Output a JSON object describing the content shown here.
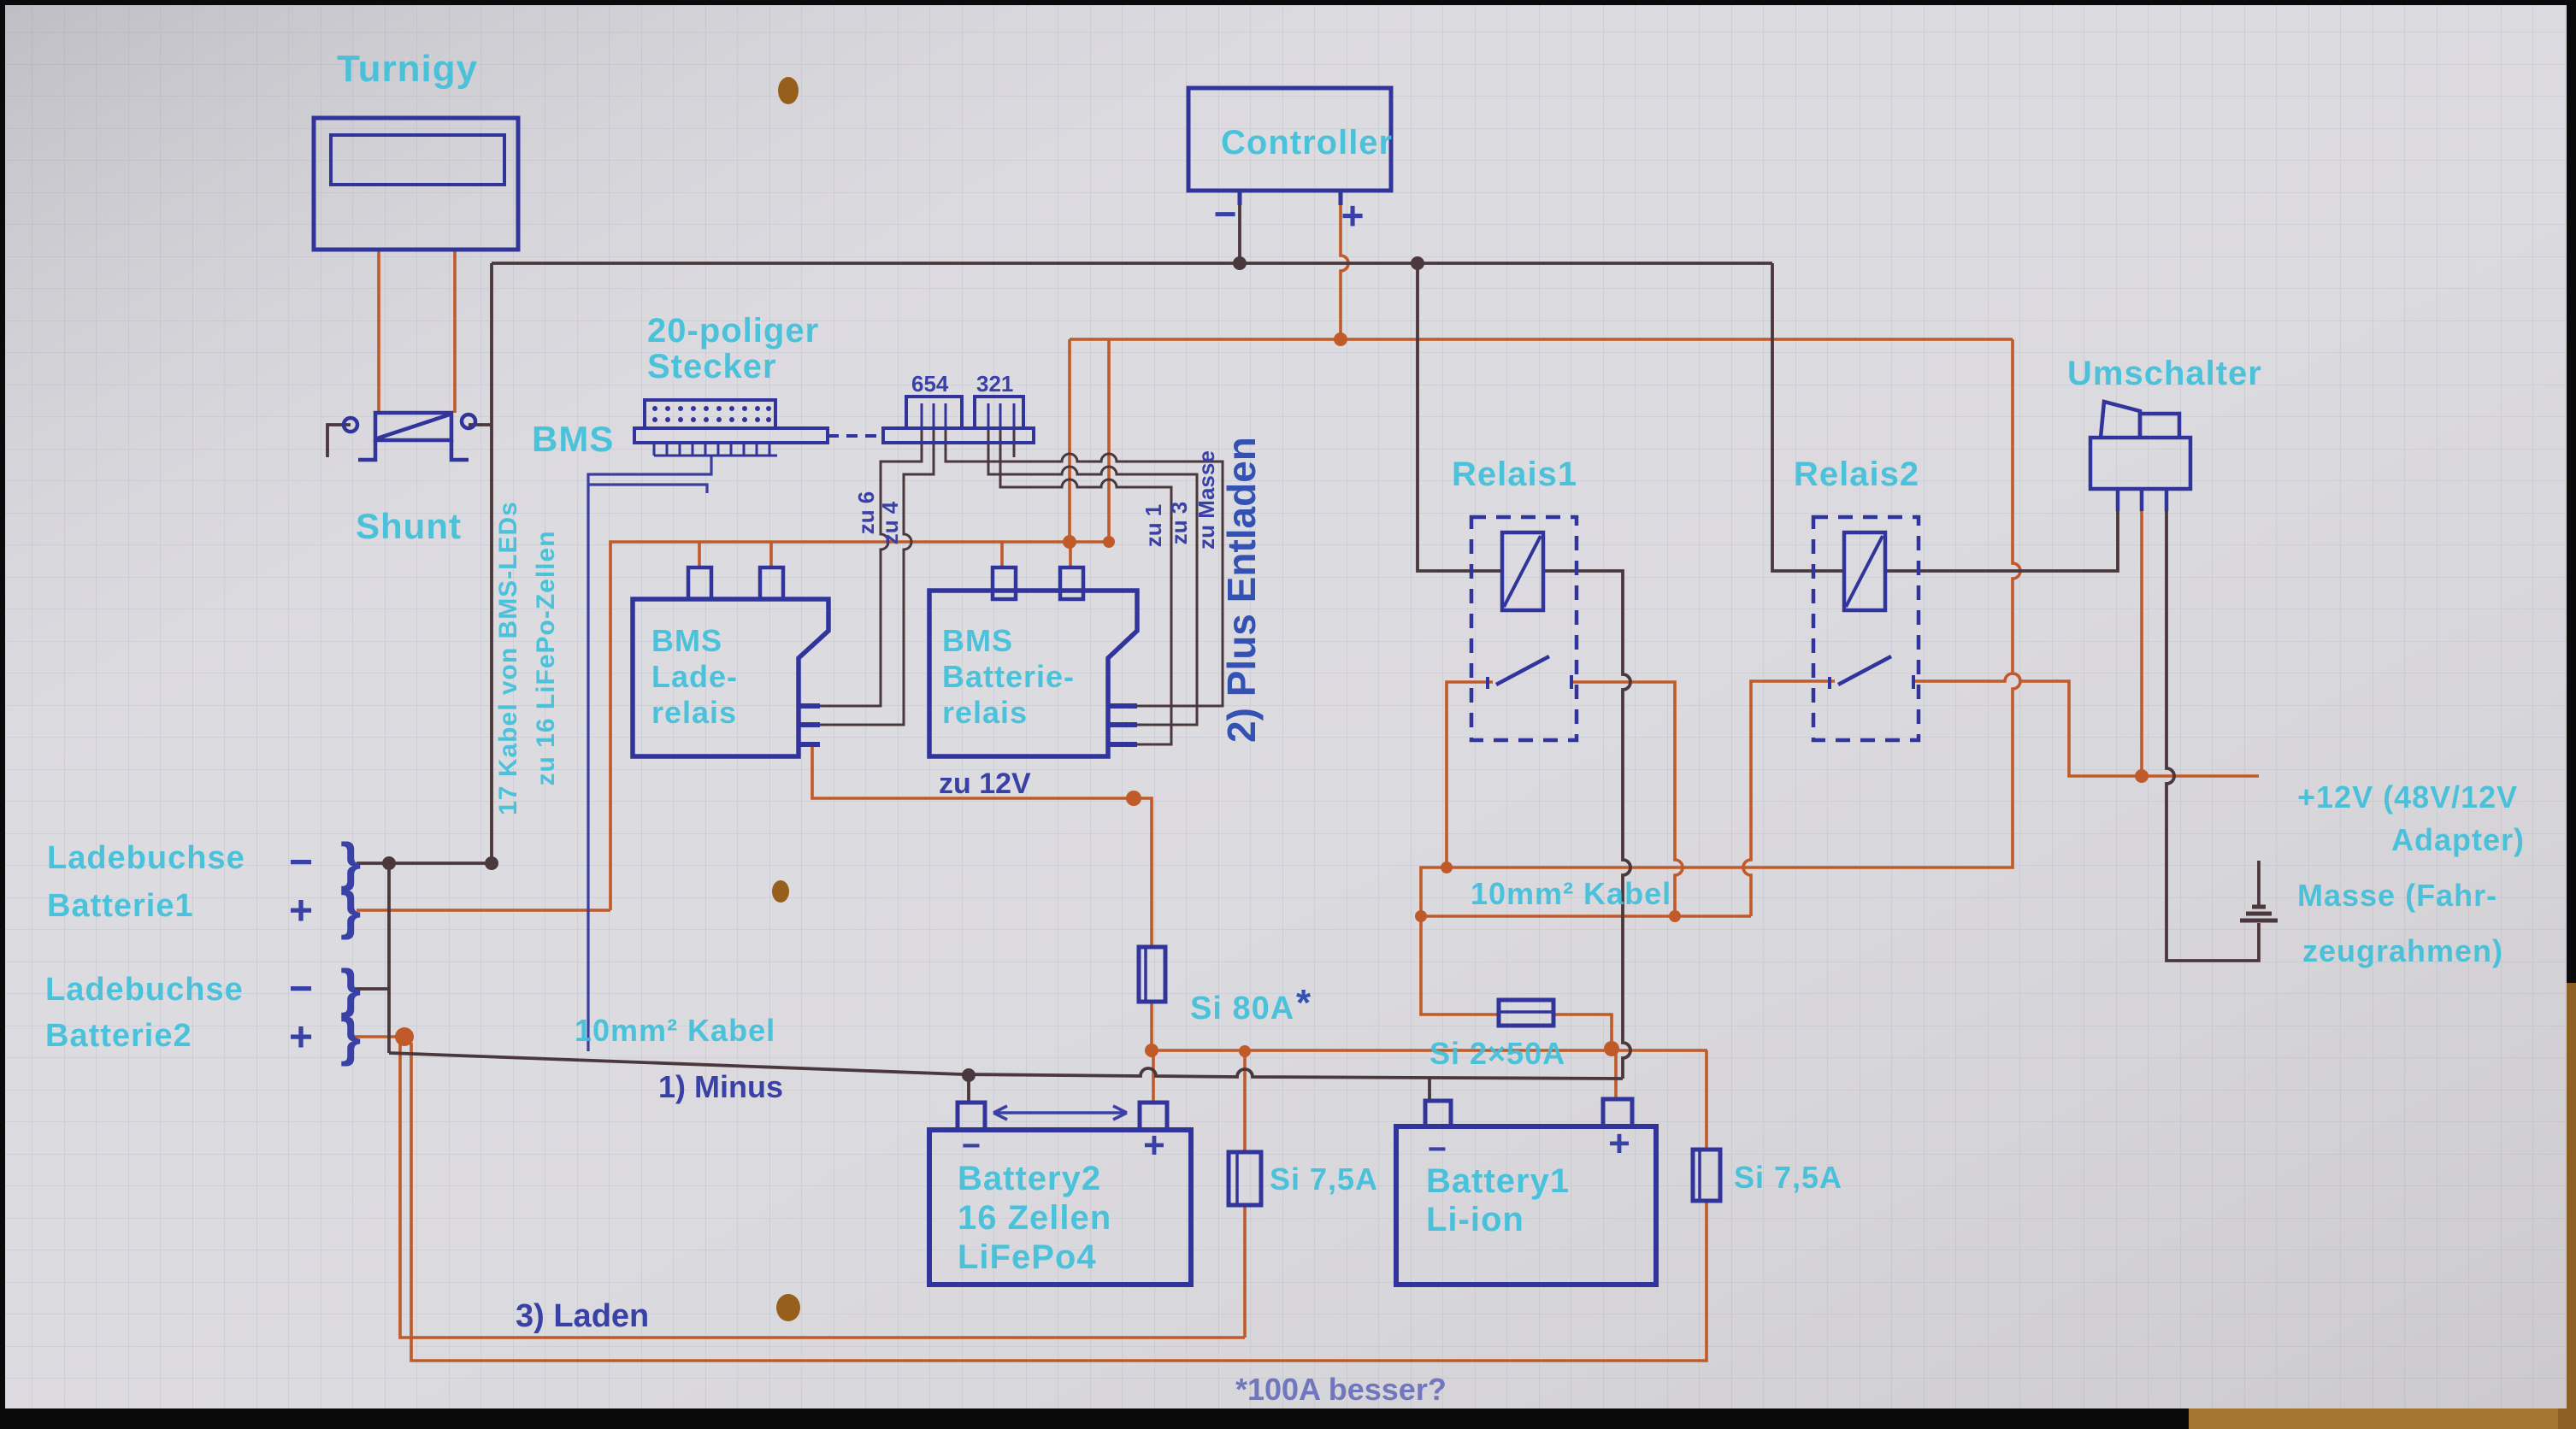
{
  "diagram_type": "hand-drawn battery wiring schematic on graph paper",
  "colors": {
    "paper": "#dcdbe0",
    "grid": "#a8afc4",
    "component_ink": "#31349b",
    "pen_blue": "#3a41a6",
    "wire_dark": "#4a383c",
    "wire_orange": "#c05a28",
    "marker_cyan": "#3fc0da",
    "wood": "#a5742e"
  },
  "labels": {
    "turnigy": "Turnigy",
    "controller": "Controller",
    "stecker_line1": "20-poliger",
    "stecker_line2": "Stecker",
    "pins_654": "654",
    "pins_321": "321",
    "bms": "BMS",
    "shunt": "Shunt",
    "kabel17_line1": "17 Kabel von BMS-LEDs",
    "kabel17_line2": "zu 16 LiFePo-Zellen",
    "bms_lade_1": "BMS",
    "bms_lade_2": "Lade-",
    "bms_lade_3": "relais",
    "bms_batt_1": "BMS",
    "bms_batt_2": "Batterie-",
    "bms_batt_3": "relais",
    "zu6": "zu 6",
    "zu4": "zu 4",
    "zu1": "zu 1",
    "zu3": "zu 3",
    "zu_masse": "zu Masse",
    "zu12v": "zu 12V",
    "plus_entladen": "2) Plus Entladen",
    "relais1": "Relais1",
    "relais2": "Relais2",
    "umschalter": "Umschalter",
    "ladebuchse1_l1": "Ladebuchse",
    "ladebuchse1_l2": "Batterie1",
    "ladebuchse2_l1": "Ladebuchse",
    "ladebuchse2_l2": "Batterie2",
    "kabel10_left": "10mm² Kabel",
    "kabel10_mid": "10mm² Kabel",
    "minus_note": "1) Minus",
    "laden_note": "3) Laden",
    "si80": "Si 80A",
    "aster": "*",
    "si2x50": "Si 2×50A",
    "si75_left": "Si 7,5A",
    "si75_right": "Si 7,5A",
    "battery2_l1": "Battery2",
    "battery2_l2": "16 Zellen",
    "battery2_l3": "LiFePo4",
    "battery1_l1": "Battery1",
    "battery1_l2": "Li-ion",
    "plus12v_l1": "+12V (48V/12V",
    "plus12v_l2": "Adapter)",
    "masse_l1": "Masse (Fahr-",
    "masse_l2": "zeugrahmen)",
    "footnote": "*100A besser?",
    "minus_sign": "−",
    "plus_sign": "+",
    "bracket": "}"
  }
}
